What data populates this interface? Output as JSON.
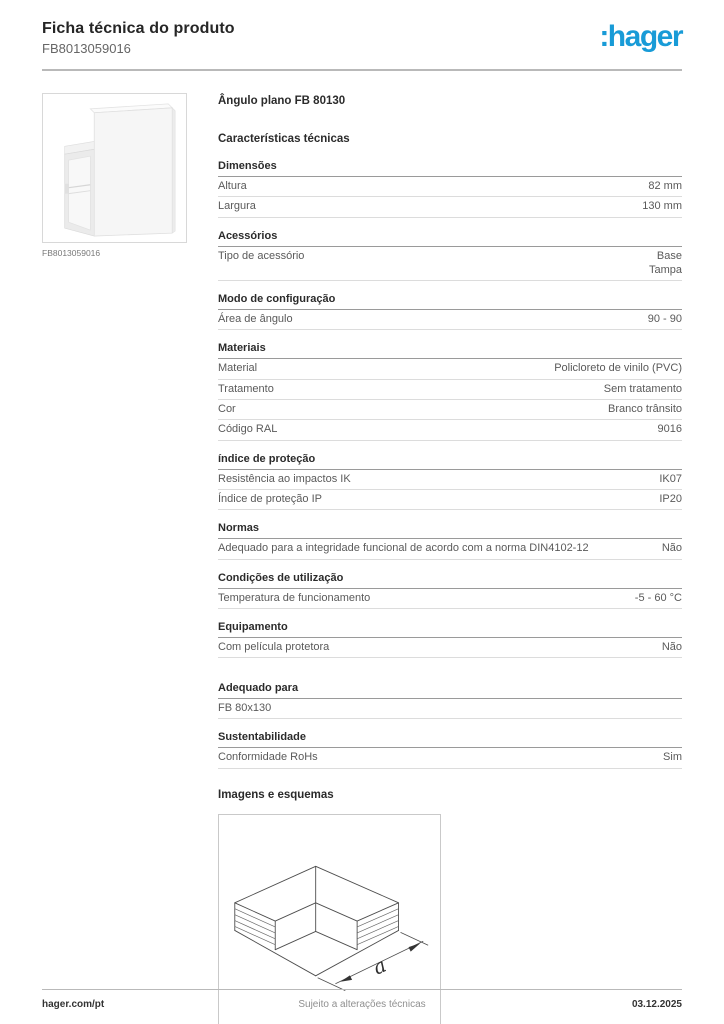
{
  "header": {
    "title": "Ficha técnica do produto",
    "reference": "FB8013059016",
    "logo_text": ":hager",
    "brand_color": "#189bd7"
  },
  "product": {
    "name": "Ângulo plano FB 80130",
    "characteristics_title": "Características técnicas",
    "image_caption": "FB8013059016"
  },
  "sections": [
    {
      "title": "Dimensões",
      "rows": [
        {
          "label": "Altura",
          "value": "82 mm"
        },
        {
          "label": "Largura",
          "value": "130 mm"
        }
      ]
    },
    {
      "title": "Acessórios",
      "rows": [
        {
          "label": "Tipo de acessório",
          "value": [
            "Base",
            "Tampa"
          ]
        }
      ]
    },
    {
      "title": "Modo de configuração",
      "rows": [
        {
          "label": "Área de ângulo",
          "value": "90 - 90"
        }
      ]
    },
    {
      "title": "Materiais",
      "rows": [
        {
          "label": "Material",
          "value": "Policloreto de vinilo (PVC)"
        },
        {
          "label": "Tratamento",
          "value": "Sem tratamento"
        },
        {
          "label": "Cor",
          "value": "Branco trânsito"
        },
        {
          "label": "Código RAL",
          "value": "9016"
        }
      ]
    },
    {
      "title": "índice de proteção",
      "rows": [
        {
          "label": "Resistência ao impactos IK",
          "value": "IK07"
        },
        {
          "label": "Índice de proteção IP",
          "value": "IP20"
        }
      ]
    },
    {
      "title": "Normas",
      "rows": [
        {
          "label": "Adequado para a integridade funcional de acordo com a norma DIN4102-12",
          "value": "Não"
        }
      ]
    },
    {
      "title": "Condições de utilização",
      "rows": [
        {
          "label": "Temperatura de funcionamento",
          "value": "-5 - 60 °C"
        }
      ]
    },
    {
      "title": "Equipamento",
      "rows": [
        {
          "label": "Com película protetora",
          "value": "Não"
        }
      ]
    },
    {
      "title": "Adequado para",
      "extra_gap": true,
      "rows": [
        {
          "label": "FB 80x130",
          "value": ""
        }
      ]
    },
    {
      "title": "Sustentabilidade",
      "rows": [
        {
          "label": "Conformidade RoHs",
          "value": "Sim"
        }
      ]
    }
  ],
  "images": {
    "title": "Imagens e esquemas",
    "dimension_label": "a"
  },
  "footer": {
    "left": "hager.com/pt",
    "center": "Sujeito a alterações técnicas",
    "right": "03.12.2025"
  }
}
